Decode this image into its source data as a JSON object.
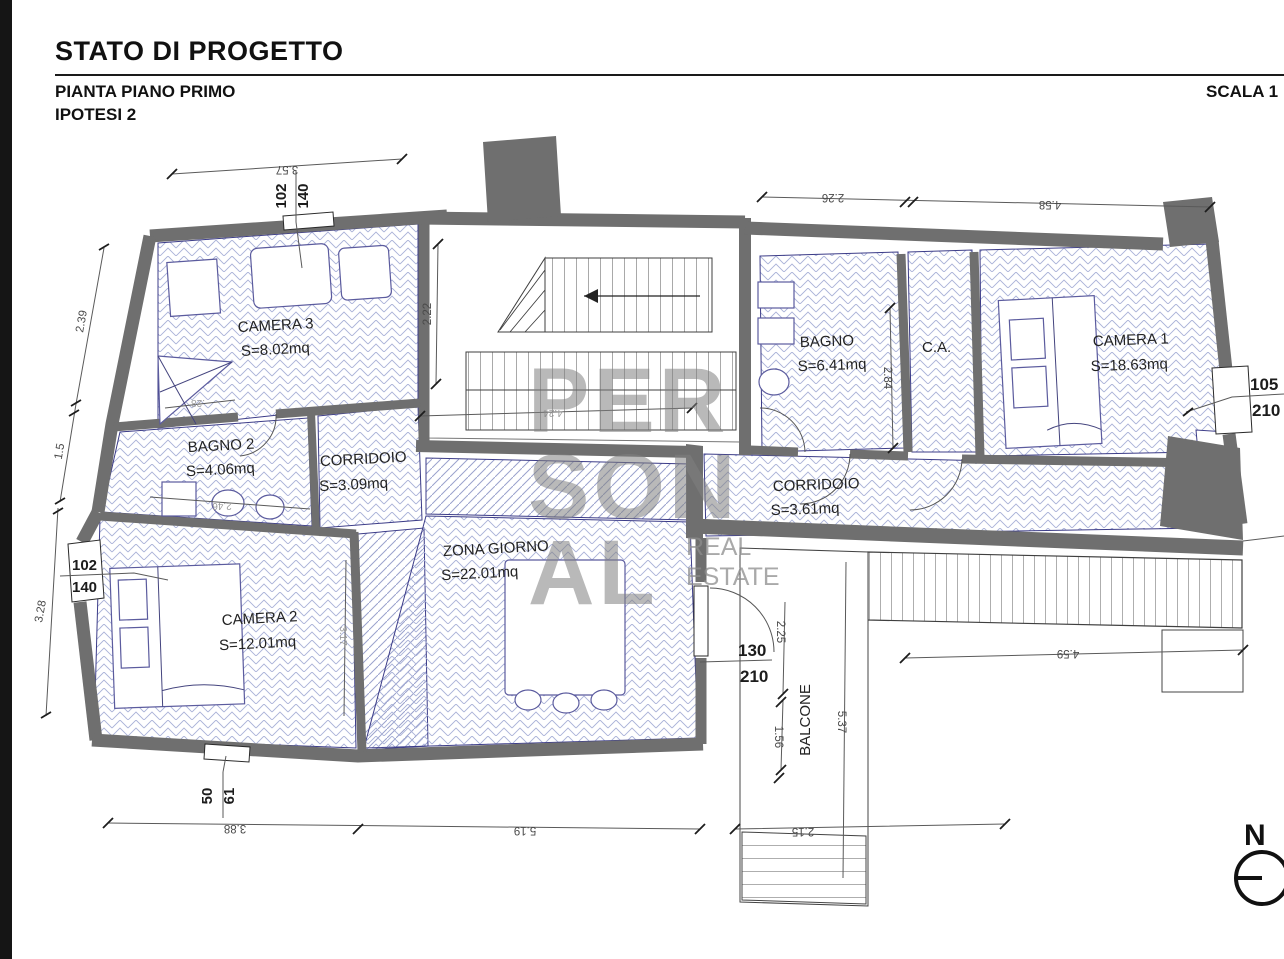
{
  "header": {
    "title": "STATO DI PROGETTO",
    "subtitle": "PIANTA PIANO PRIMO",
    "variant": "IPOTESI 2",
    "scale": "SCALA 1"
  },
  "watermark": {
    "line1": "PER",
    "line2": "SON",
    "line3": "AL",
    "sub_line1": "REAL",
    "sub_line2": "ESTATE"
  },
  "north": {
    "label": "N"
  },
  "rooms": {
    "camera3": {
      "name": "CAMERA 3",
      "area": "S=8.02mq"
    },
    "bagno2": {
      "name": "BAGNO 2",
      "area": "S=4.06mq"
    },
    "corridoio1": {
      "name": "CORRIDOIO",
      "area": "S=3.09mq"
    },
    "zona_giorno": {
      "name": "ZONA GIORNO",
      "area": "S=22.01mq"
    },
    "camera2": {
      "name": "CAMERA 2",
      "area": "S=12.01mq"
    },
    "bagno": {
      "name": "BAGNO",
      "area": "S=6.41mq"
    },
    "ca": {
      "name": "C.A."
    },
    "camera1": {
      "name": "CAMERA 1",
      "area": "S=18.63mq"
    },
    "corridoio2": {
      "name": "CORRIDOIO",
      "area": "S=3.61mq"
    },
    "balcone": {
      "name": "BALCONE"
    }
  },
  "dimensions": {
    "top_left": "3.57",
    "left_upper": "2.39",
    "left_mid": "1.5",
    "left_lower": "3.28",
    "stair_height": "2.22",
    "stair_width": "4.24",
    "top_right_a": "2.26",
    "top_right_b": "4.58",
    "bagno_depth": "2.84",
    "camera2_depth": "3.17",
    "bagno2_width": "2.46",
    "camera3_offset": ".28",
    "balcony_a": "2.25",
    "balcony_b": "1.56",
    "balcony_len": "5.37",
    "balcony_bottom": "4.59",
    "bottom_a": "3.88",
    "bottom_b": "5.19",
    "bottom_c": "2.15"
  },
  "openings": {
    "window_top": {
      "w": "102",
      "h": "140"
    },
    "window_left": {
      "w": "102",
      "h": "140"
    },
    "window_right": {
      "w": "105",
      "h": "210"
    },
    "door_balcony": {
      "w": "130",
      "h": "210"
    },
    "window_small": {
      "w": "50",
      "h": "61"
    }
  },
  "colors": {
    "wall": "#6f6f6f",
    "hatch": "#aab2d8",
    "outline": "#3c3c88",
    "dim_text": "#4a4a4a",
    "label_text": "#232323",
    "watermark": "#808080"
  }
}
